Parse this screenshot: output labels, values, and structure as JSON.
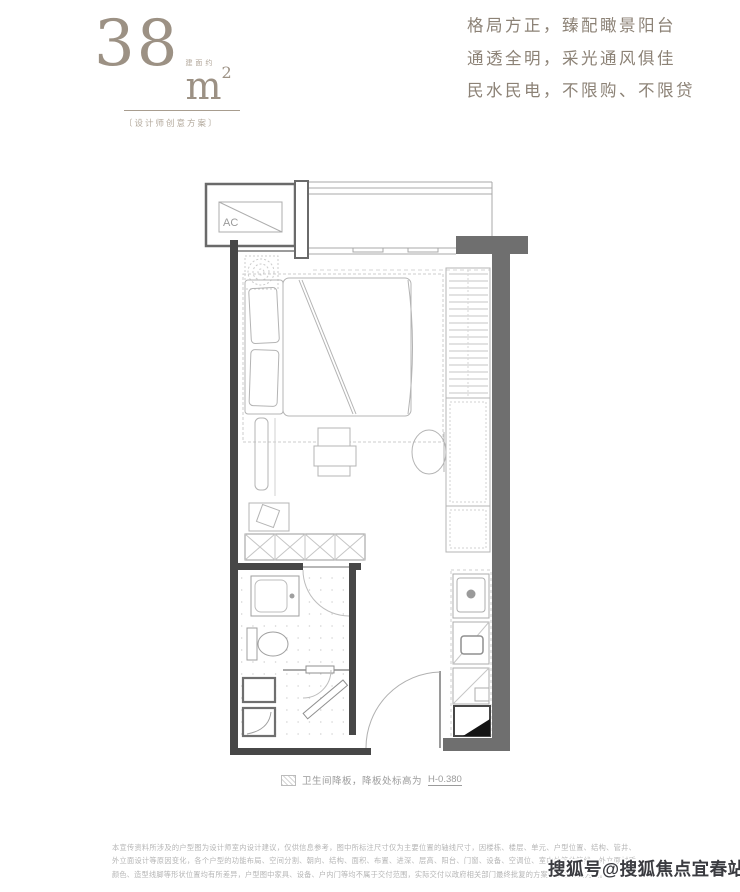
{
  "header": {
    "area": {
      "value": "38",
      "prefix": "建面约",
      "unit": "m",
      "superscript": "2"
    },
    "subtitle": "〔设计师创意方案〕",
    "slogan_lines": [
      "格局方正，臻配瞰景阳台",
      "通透全明，采光通风俱佳",
      "民水民电，不限购、不限贷"
    ]
  },
  "floorplan": {
    "ac_label": "AC",
    "legend_text": "卫生间降板，降板处标高为",
    "legend_value": "H-0.380"
  },
  "footer": {
    "disclaimer": "本宣传资料所涉及的户型图为设计师室内设计建议，仅供信息参考，图中所标注尺寸仅为主要位置的轴线尺寸，因楼栋、楼层、单元、户型位置、结构、管井、外立面设计等原因变化，各个户型的功能布局、空间分割、朝向、结构、面积、布置、进深、层高、阳台、门窗、设备、空调位、室内外管井管线、外立面材质颜色、造型线脚等形状位置均有所差异，户型图中家具、设备、户内门等均不属于交付范围，实际交付以政府相关部门最终批复的方案和销售合同为准。"
  },
  "watermark": {
    "text": "搜狐号@搜狐焦点宜春站"
  },
  "colors": {
    "accent_taupe": "#9c9184",
    "slogan_text": "#8c8276",
    "wall_dark_fill": "#6f6f6f",
    "wall_black": "#474747",
    "furniture_line": "#b4b4b4",
    "caption_gray": "#9b9b9b",
    "disclaimer_gray": "#b5b5b5",
    "watermark_dark": "#3a3b40"
  }
}
